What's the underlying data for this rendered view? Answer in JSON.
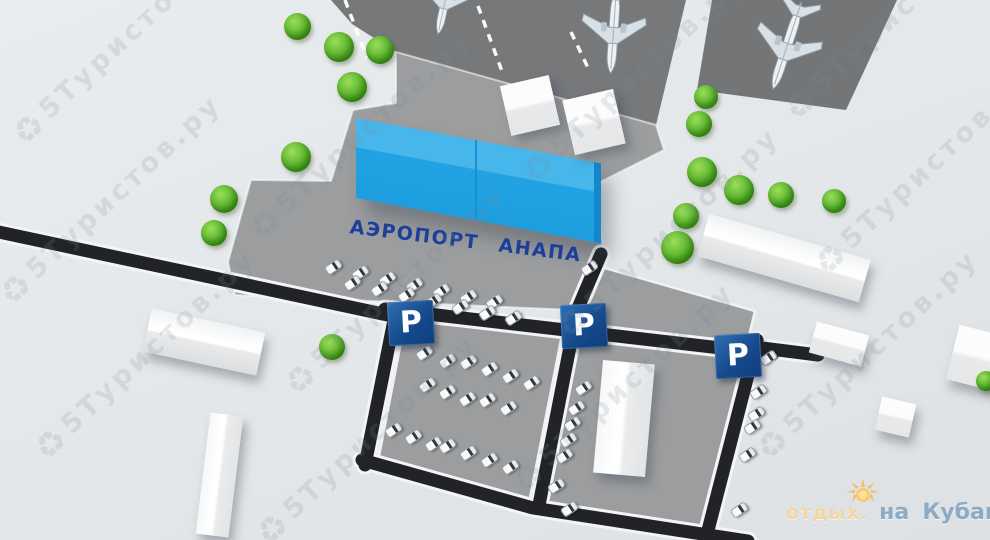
{
  "terminal": {
    "label": "АЭРОПОРТ АНАПА",
    "label_color": "#1d3e9b",
    "roof_color": "#47b6ea",
    "front_color": "#1d9edf"
  },
  "parking": {
    "sign_label": "P",
    "sign_color": "#164a8c",
    "positions": [
      [
        388,
        301
      ],
      [
        561,
        304
      ],
      [
        715,
        334
      ]
    ]
  },
  "watermark": {
    "icon": "♻",
    "text": "5Туристов.ру",
    "positions": [
      [
        18,
        140
      ],
      [
        5,
        300
      ],
      [
        40,
        455
      ],
      [
        255,
        235
      ],
      [
        290,
        390
      ],
      [
        262,
        540
      ],
      [
        528,
        178
      ],
      [
        563,
        333
      ],
      [
        518,
        488
      ],
      [
        790,
        115
      ],
      [
        762,
        455
      ],
      [
        820,
        270
      ]
    ]
  },
  "logo": {
    "prefix": "отдых.",
    "word_na": "на",
    "word_kubani": "Кубани",
    "suffix": ".ру",
    "sun_color": "#f9c86d"
  },
  "scene": {
    "road_color": "#212326",
    "apron_color": "#76787a",
    "lot_color": "#9c9d9e",
    "cars": [
      [
        333,
        267
      ],
      [
        360,
        273
      ],
      [
        387,
        279
      ],
      [
        414,
        285
      ],
      [
        441,
        291
      ],
      [
        468,
        297
      ],
      [
        494,
        302
      ],
      [
        352,
        283
      ],
      [
        379,
        289
      ],
      [
        406,
        295
      ],
      [
        433,
        301
      ],
      [
        460,
        307
      ],
      [
        487,
        313
      ],
      [
        513,
        318
      ],
      [
        424,
        353
      ],
      [
        447,
        361
      ],
      [
        468,
        362
      ],
      [
        489,
        369
      ],
      [
        510,
        376
      ],
      [
        531,
        383
      ],
      [
        427,
        385
      ],
      [
        447,
        392
      ],
      [
        467,
        399
      ],
      [
        487,
        400
      ],
      [
        508,
        408
      ],
      [
        393,
        430
      ],
      [
        413,
        437
      ],
      [
        433,
        444
      ],
      [
        447,
        446
      ],
      [
        468,
        453
      ],
      [
        489,
        460
      ],
      [
        510,
        467
      ],
      [
        583,
        388
      ],
      [
        576,
        408
      ],
      [
        572,
        424
      ],
      [
        568,
        440
      ],
      [
        564,
        456
      ],
      [
        556,
        486
      ],
      [
        569,
        509
      ],
      [
        768,
        358
      ],
      [
        758,
        392
      ],
      [
        756,
        414
      ],
      [
        752,
        427
      ],
      [
        747,
        455
      ],
      [
        739,
        510
      ],
      [
        589,
        268
      ]
    ],
    "trees": [
      [
        297,
        26,
        27
      ],
      [
        339,
        47,
        30
      ],
      [
        380,
        50,
        28
      ],
      [
        352,
        87,
        30
      ],
      [
        296,
        157,
        30
      ],
      [
        224,
        199,
        28
      ],
      [
        214,
        233,
        26
      ],
      [
        332,
        347,
        26
      ],
      [
        706,
        97,
        24
      ],
      [
        699,
        124,
        26
      ],
      [
        702,
        172,
        30
      ],
      [
        739,
        190,
        30
      ],
      [
        781,
        195,
        26
      ],
      [
        686,
        216,
        26
      ],
      [
        677,
        247,
        33
      ],
      [
        834,
        201,
        24
      ],
      [
        986,
        381,
        20
      ]
    ],
    "planes": [
      [
        447,
        -8,
        192,
        1.0
      ],
      [
        614,
        24,
        184,
        1.15
      ],
      [
        789,
        40,
        198,
        1.2
      ]
    ]
  }
}
